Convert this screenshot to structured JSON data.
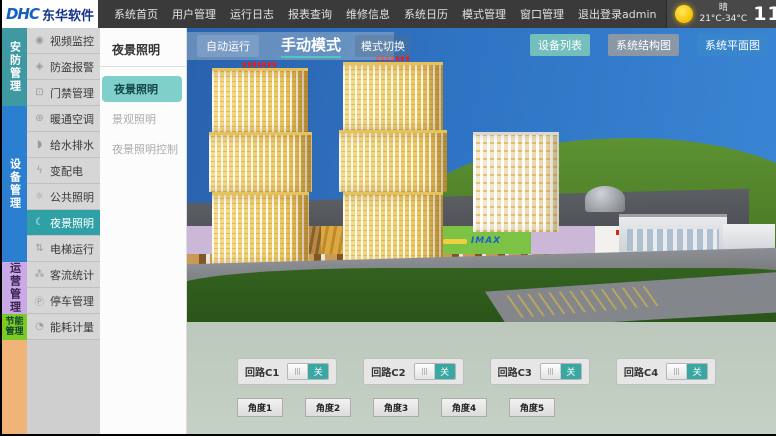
{
  "header": {
    "logo": {
      "brand": "DHC",
      "company": "东华软件"
    },
    "menu": [
      "系统首页",
      "用户管理",
      "运行日志",
      "报表查询",
      "维修信息",
      "系统日历",
      "模式管理",
      "窗口管理",
      "退出登录"
    ],
    "user": "admin",
    "weather": {
      "icon": "sun-icon",
      "condition": "晴",
      "temp_range": "21°C-34°C",
      "time": "11:23",
      "weekday": "星期一",
      "date": "2015-6-15"
    }
  },
  "sidebar": {
    "categories": [
      {
        "label": "安防管理",
        "color": "#3e99a3",
        "items": [
          {
            "label": "视频监控",
            "icon": "camera-icon",
            "glyph": "◉"
          },
          {
            "label": "防盗报警",
            "icon": "shield-icon",
            "glyph": "◈"
          },
          {
            "label": "门禁管理",
            "icon": "lock-icon",
            "glyph": "⊡"
          }
        ]
      },
      {
        "label": "设备管理",
        "color": "#2a7fd0",
        "items": [
          {
            "label": "暖通空调",
            "icon": "fan-icon",
            "glyph": "⊛"
          },
          {
            "label": "给水排水",
            "icon": "water-drop-icon",
            "glyph": "◗"
          },
          {
            "label": "变配电",
            "icon": "lightning-icon",
            "glyph": "ϟ"
          },
          {
            "label": "公共照明",
            "icon": "light-icon",
            "glyph": "☼"
          },
          {
            "label": "夜景照明",
            "icon": "moon-icon",
            "glyph": "☾",
            "selected": true
          },
          {
            "label": "电梯运行",
            "icon": "elevator-icon",
            "glyph": "⇅"
          }
        ]
      },
      {
        "label": "运营管理",
        "color": "#c9a9e6",
        "items": [
          {
            "label": "客流统计",
            "icon": "people-icon",
            "glyph": "⁂"
          },
          {
            "label": "停车管理",
            "icon": "parking-icon",
            "glyph": "Ⓟ"
          }
        ]
      },
      {
        "label": "节能管理",
        "color": "#7ccb22",
        "items": [
          {
            "label": "能耗计量",
            "icon": "meter-icon",
            "glyph": "◔"
          }
        ]
      }
    ],
    "filler_color": "#f0b478"
  },
  "subnav": {
    "title": "夜景照明",
    "items": [
      {
        "label": "夜景照明",
        "selected": true
      },
      {
        "label": "景观照明"
      },
      {
        "label": "夜景照明控制"
      }
    ],
    "selected_color": "#7fd0ca"
  },
  "main": {
    "mode_bar": {
      "auto_label": "自动运行",
      "current_mode": "手动模式",
      "switch_label": "模式切换"
    },
    "view_buttons": [
      {
        "label": "设备列表",
        "color": "#7dc8b9"
      },
      {
        "label": "系统结构图",
        "color": "#969ba0"
      },
      {
        "label": "系统平面图",
        "color": "#3a86cc"
      }
    ],
    "scene": {
      "description": "3D rendering of a shopping mall complex with twin yellow towers, green hill, parking lot",
      "imax_sign": "IMAX"
    },
    "circuits": [
      {
        "label": "回路C1",
        "state": "关"
      },
      {
        "label": "回路C2",
        "state": "关"
      },
      {
        "label": "回路C3",
        "state": "关"
      },
      {
        "label": "回路C4",
        "state": "关"
      }
    ],
    "angle_buttons": [
      "角度1",
      "角度2",
      "角度3",
      "角度4",
      "角度5"
    ],
    "toggle_on_color": "#3aa7a3"
  }
}
